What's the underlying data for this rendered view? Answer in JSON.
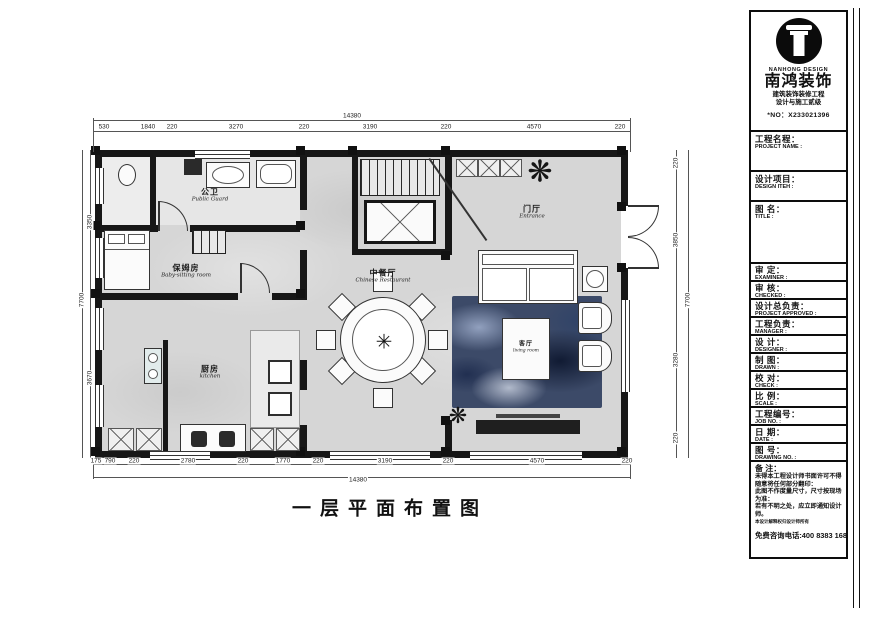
{
  "title_block": {
    "logo": {
      "brand_en": "NANHONG DESIGN",
      "brand_cn": "南鸿装饰",
      "line1": "建筑装饰装修工程",
      "line2": "设计与施工贰级",
      "no": "*NO：X233021396"
    },
    "fields": [
      {
        "cn": "工程名程：",
        "en": "PROJECT NAME :"
      },
      {
        "cn": "设计项目：",
        "en": "DESIGN ITEH :"
      },
      {
        "cn": "图 名：",
        "en": "TITLE :"
      },
      {
        "cn": "审 定：",
        "en": "EXAMINER :"
      },
      {
        "cn": "审 核：",
        "en": "CHECKED :"
      },
      {
        "cn": "设计总负责：",
        "en": "PROJECT APPROVED :"
      },
      {
        "cn": "工程负责：",
        "en": "MANAGER :"
      },
      {
        "cn": "设 计：",
        "en": "DESIGNER :"
      },
      {
        "cn": "制 图：",
        "en": "DRAWN :"
      },
      {
        "cn": "校 对：",
        "en": "CHECK :"
      },
      {
        "cn": "比 例：",
        "en": "SCALE :"
      },
      {
        "cn": "工程编号：",
        "en": "JOB NO. :"
      },
      {
        "cn": "日 期：",
        "en": "DATE :"
      },
      {
        "cn": "图 号：",
        "en": "DRAWING NO. :"
      }
    ],
    "notes": {
      "heading": "备 注：",
      "lines": [
        "未得本工程设计师书面许可不得随意将任何部分翻印：",
        "此图不作度量尺寸，尺寸按现场为准：",
        "若有不明之处，应立即通知设计师。"
      ],
      "tiny": "本设计解释权归设计师所有",
      "hotline": "免费咨询电话:400 8383 168"
    }
  },
  "plan": {
    "title": "一层平面布置图",
    "rooms": [
      {
        "cn": "公卫",
        "en": "Public Guard"
      },
      {
        "cn": "保姆房",
        "en": "Baby-sitting room"
      },
      {
        "cn": "厨房",
        "en": "kitchen"
      },
      {
        "cn": "中餐厅",
        "en": "Chinese Restaurant"
      },
      {
        "cn": "门厅",
        "en": "Entrance"
      },
      {
        "cn": "客厅",
        "en": "living room"
      }
    ],
    "dims": {
      "top_total": "14380",
      "top": [
        "530",
        "1840",
        "220",
        "3270",
        "220",
        "3190",
        "220",
        "4570",
        "220"
      ],
      "bottom_total": "14380",
      "bottom": [
        "175",
        "790",
        "220",
        "2780",
        "220",
        "1770",
        "220",
        "3190",
        "220",
        "4570",
        "220"
      ],
      "left": [
        "3350",
        "3670"
      ],
      "left_total": "7700",
      "right": [
        "220",
        "3850",
        "3280",
        "220"
      ],
      "right_total": "7700"
    },
    "colors": {
      "wall": "#171717",
      "floor": "#d6d6d6",
      "rug": "#3c4a68"
    }
  }
}
